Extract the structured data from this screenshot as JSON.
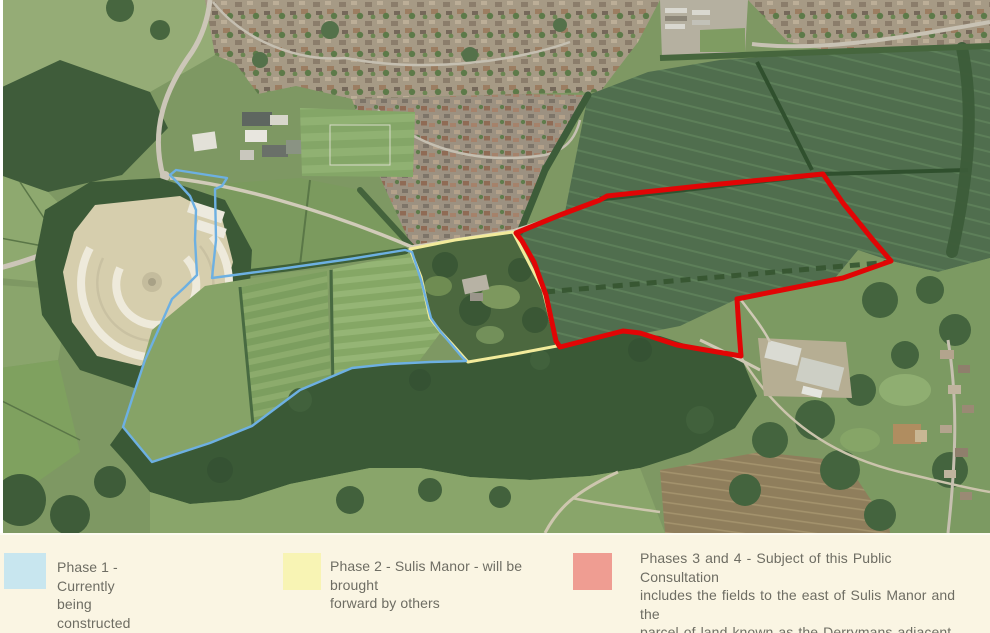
{
  "legend": {
    "background_color": "#faf5e3",
    "text_color": "#6e6d63",
    "items": [
      {
        "id": "phase-1",
        "swatch_color": "#c8e6ef",
        "lines": [
          "Phase 1 - Currently being constructed"
        ]
      },
      {
        "id": "phase-2",
        "swatch_color": "#f8f4b4",
        "lines": [
          "Phase 2 - Sulis Manor - will be brought",
          "forward by others"
        ]
      },
      {
        "id": "phases-3-4",
        "swatch_color": "#ef9d92",
        "lines": [
          "Phases 3 and 4 - Subject of this Public Consultation",
          "includes the fields to the east of Sulis Manor and the",
          "parcel of land known as the Derrymans adjacent",
          "to the Park and Ride."
        ]
      }
    ]
  },
  "map": {
    "type": "aerial-photograph",
    "outlines": {
      "phase1": {
        "color": "#6db0e2",
        "points": "170,175 176,170 227,178 222,186 215,189 216,240 212,278 287,268 350,259 405,250 412,252 421,280 431,318 440,331 462,357 466,361 430,362 390,364 352,368 300,390 252,426 210,443 152,462 123,427 133,396 145,360 157,333 172,299 185,287 197,275 195,240 196,210 190,196 178,183"
      },
      "phase2": {
        "color": "#f2eb9b",
        "points": "410,249 455,240 513,232 543,290 557,346 515,354 468,362 452,344 440,331 430,318 421,277"
      },
      "phases3and4": {
        "color": "#e10505",
        "points": "516,233 560,215 600,200 607,196 700,186 823,174 843,203 873,240 891,261 843,278 777,291 737,299 739,330 741,356 700,349 677,345 640,333 623,331 560,347 556,341 546,295 534,262 522,241"
      }
    }
  }
}
